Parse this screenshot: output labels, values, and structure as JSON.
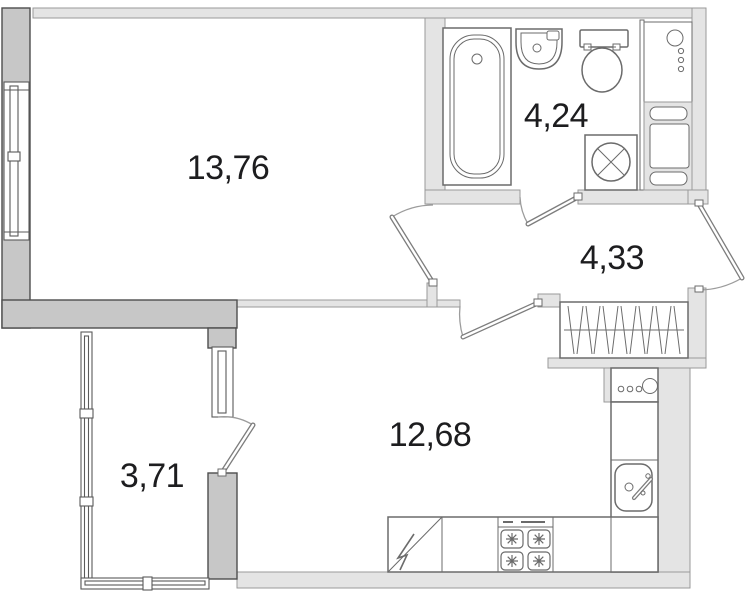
{
  "plan_type": "apartment-floor-plan",
  "rooms": [
    {
      "name": "living-room",
      "area": "13,76"
    },
    {
      "name": "bathroom",
      "area": "4,24"
    },
    {
      "name": "hallway",
      "area": "4,33"
    },
    {
      "name": "kitchen",
      "area": "12,68"
    },
    {
      "name": "balcony",
      "area": "3,71"
    }
  ],
  "icons": [
    "bathtub-icon",
    "washbasin-icon",
    "toilet-icon",
    "washing-machine-icon",
    "riser-pipes-icon",
    "utility-shaft-icon",
    "wardrobe-icon",
    "kitchen-panel-icon",
    "kitchen-sink-icon",
    "stove-icon",
    "fridge-icon",
    "window-icon",
    "door-icon"
  ],
  "colors": {
    "background": "#ffffff",
    "wall_dark": "#c7c7c7",
    "wall_dark_stroke": "#4e4e4e",
    "wall_light": "#e4e4e4",
    "wall_light_stroke": "#9a9a9a",
    "fixture_stroke": "#6b6b6b",
    "window_stroke": "#5a5a5a",
    "door_stroke": "#7d7d7d",
    "arc_stroke": "#9c9c9c",
    "text": "#1d1d1f"
  }
}
